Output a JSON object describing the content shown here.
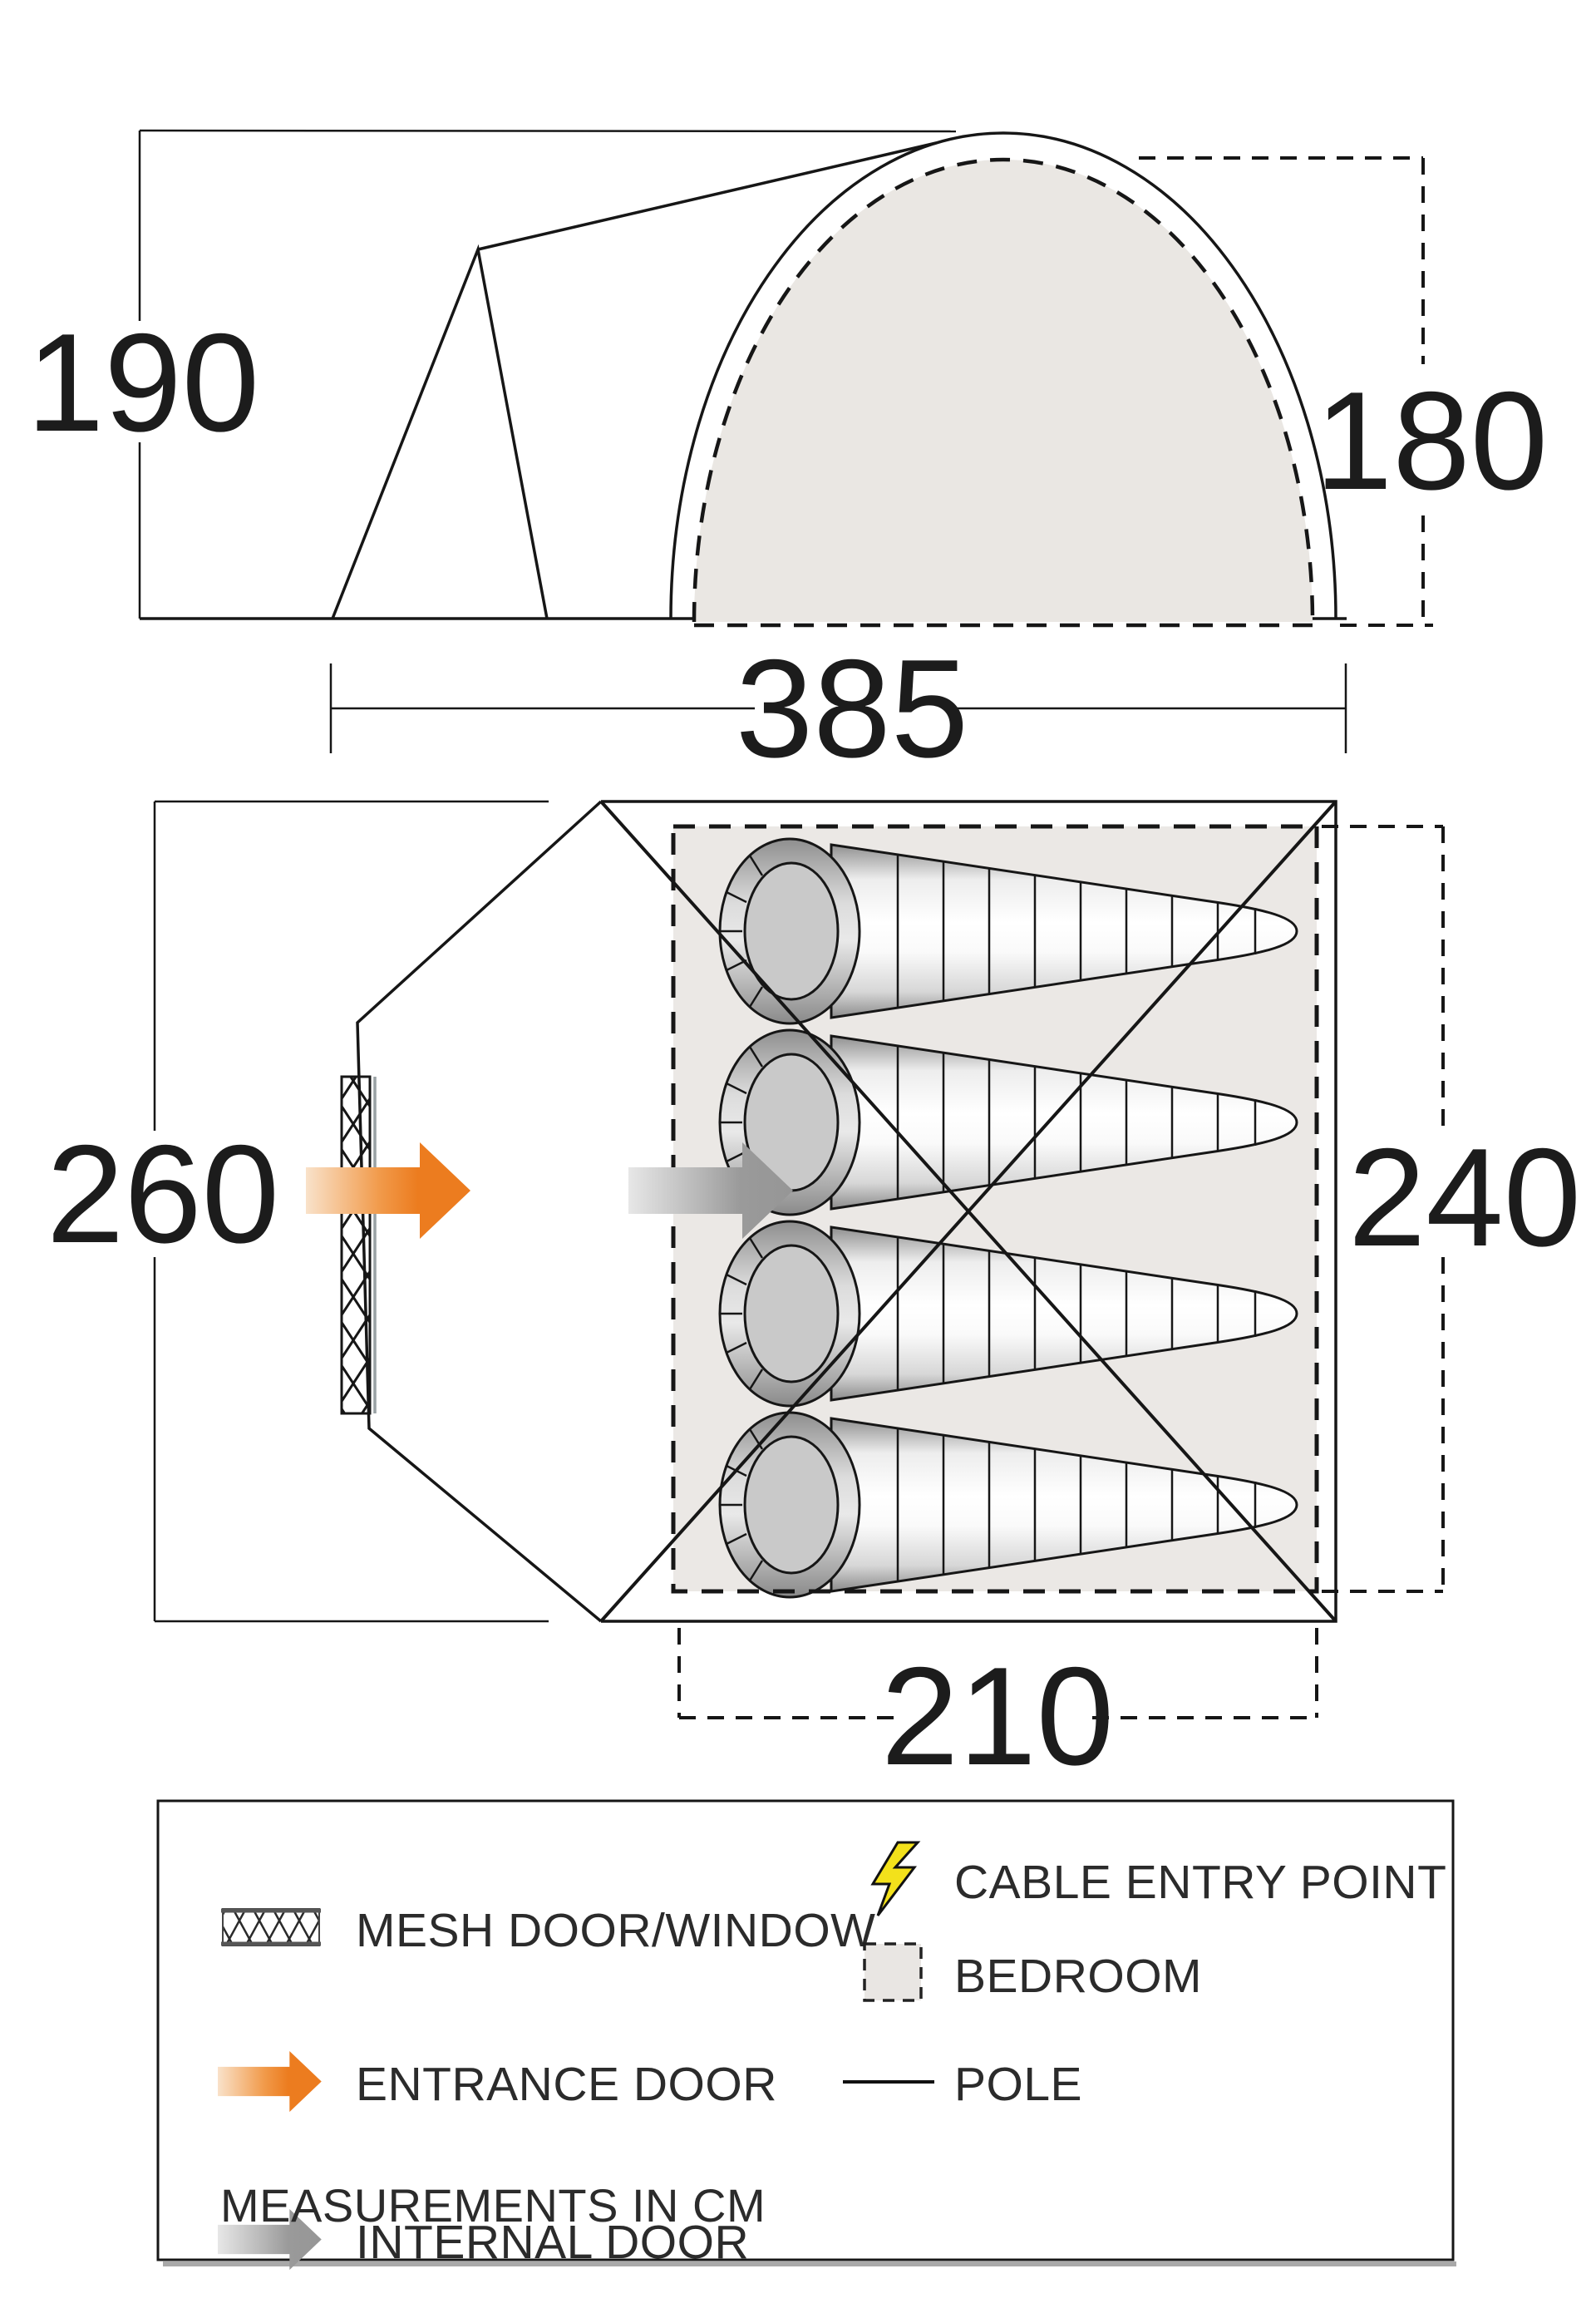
{
  "side_view": {
    "label_height_outer": "190",
    "label_height_inner": "180",
    "label_width": "385"
  },
  "floor_plan": {
    "label_depth_total": "260",
    "label_depth_bedroom": "240",
    "label_width_bedroom": "210"
  },
  "legend": {
    "items": [
      {
        "id": "mesh",
        "label": "MESH DOOR/WINDOW"
      },
      {
        "id": "entrance",
        "label": "ENTRANCE DOOR"
      },
      {
        "id": "internal",
        "label": "INTERNAL DOOR"
      },
      {
        "id": "cable",
        "label": "CABLE ENTRY POINT"
      },
      {
        "id": "bedroom",
        "label": "BEDROOM"
      },
      {
        "id": "pole",
        "label": "POLE"
      }
    ],
    "note": "MEASUREMENTS IN CM"
  },
  "colors": {
    "line": "#161616",
    "accent_orange": "#ec7c1f",
    "arrow_gray": "#9a9a9a",
    "bolt_yellow": "#f3e11b",
    "bedroom_fill": "#ebe8e5",
    "dome_fill": "#eae7e3"
  }
}
